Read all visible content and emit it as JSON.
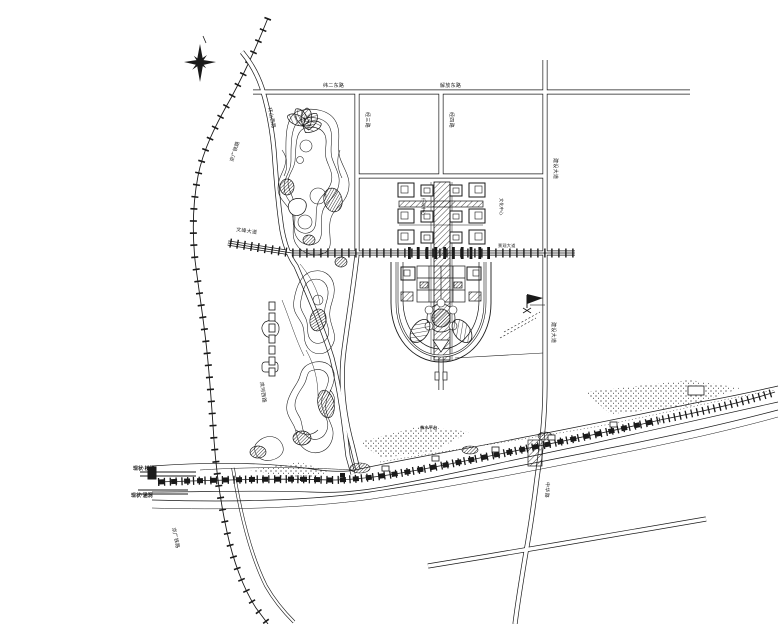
{
  "drawing": {
    "palette": {
      "ink": "#1a1a1a",
      "paper": "#ffffff"
    },
    "north_arrow": "north-star",
    "labels": {
      "rail_upper": "京广铁路",
      "rail_lower": "京广铁路",
      "road_top_west": "纬二东路",
      "road_top_east": "解放东路",
      "road_v1": "经三路",
      "road_v2": "经四路",
      "road_right": "建设大道",
      "road_right_lower": "建设大道",
      "boulevard_west": "文峰大道",
      "boulevard_east": "景观大道",
      "park_road": "环山西路",
      "park_road_lower": "滨河西路",
      "axis_left": "行政中心",
      "axis_right": "文化中心",
      "river_label": "亲水平台",
      "south_road": "中华路",
      "station_line1": "现状·桥梁",
      "station_line2": "现状·涵洞"
    }
  }
}
